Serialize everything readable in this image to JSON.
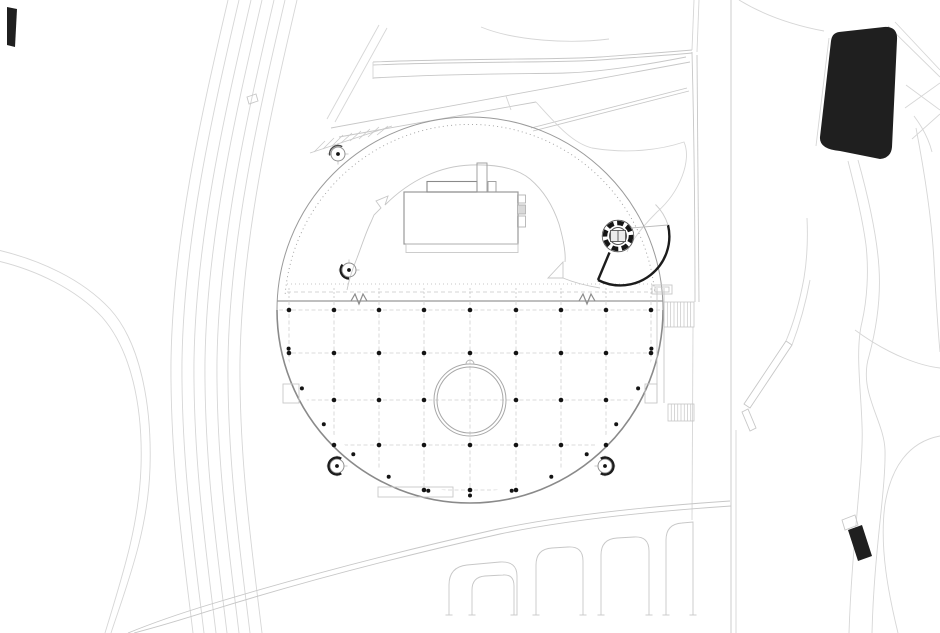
{
  "meta": {
    "type": "architectural-site-plan",
    "width": 940,
    "height": 633,
    "visible_text": "none"
  },
  "colors": {
    "paper": "#ffffff",
    "ink": "#1f1f1f",
    "line_dark": "#8c8c8c",
    "line_mid": "#a8a8a8",
    "line_light": "#c7c7c7",
    "line_faint": "#dedede",
    "dot": "#141414"
  },
  "plaza": {
    "cx": 470,
    "cy": 310,
    "r": 193,
    "chord_y": 301
  },
  "grid": {
    "columns_x": [
      289,
      334,
      379,
      424,
      470,
      516,
      561,
      606,
      651
    ],
    "rows_y": [
      310,
      353,
      400,
      445,
      490
    ],
    "grid_bottom_y": 504,
    "dot_radius": 2.3,
    "dot_rows": [
      {
        "y": 310,
        "x": [
          289,
          334,
          379,
          424,
          470,
          516,
          561,
          606,
          651
        ]
      },
      {
        "y": 353,
        "x": [
          289,
          334,
          379,
          424,
          470,
          516,
          561,
          606,
          651
        ]
      },
      {
        "y": 400,
        "x": [
          334,
          379,
          424,
          516,
          561,
          606
        ]
      },
      {
        "y": 445,
        "x": [
          334,
          379,
          424,
          470,
          516,
          561,
          606
        ]
      },
      {
        "y": 490,
        "x": [
          424,
          470,
          516
        ]
      }
    ],
    "perimeter": {
      "r": 185.5,
      "angles_deg": [
        12,
        25,
        38,
        51,
        64,
        77,
        90,
        103,
        116,
        129,
        142,
        155,
        168
      ]
    }
  },
  "central_opening": {
    "cx": 470,
    "cy": 400,
    "r_outer": 36,
    "r_inner": 33
  },
  "ramp": {
    "cx": 618,
    "cy": 236,
    "ring_r": 13,
    "ring_width": 4.5,
    "inner_r": 8.5,
    "fan_r": 49
  },
  "survey_markers": [
    {
      "x": 338,
      "y": 154,
      "ring_r": 7,
      "arc": {
        "r": 8.5,
        "from": 170,
        "to": 300,
        "width": 1.4,
        "color": "#4a4a4a"
      }
    },
    {
      "x": 349,
      "y": 270,
      "ring_r": 7,
      "arc": {
        "r": 8.5,
        "from": 90,
        "to": 220,
        "width": 2.2,
        "color": "#1c1c1c"
      }
    },
    {
      "x": 337,
      "y": 466,
      "ring_r": 7,
      "arc": {
        "r": 8.5,
        "from": 60,
        "to": 300,
        "width": 2.4,
        "color": "#1c1c1c"
      }
    },
    {
      "x": 605,
      "y": 466,
      "ring_r": 7,
      "arc": {
        "r": 8.5,
        "from": 240,
        "to": 480,
        "width": 2.4,
        "color": "#1c1c1c"
      }
    }
  ],
  "stairs": [
    {
      "x": 664,
      "y": 302,
      "w": 30,
      "h": 25,
      "treads": 9
    },
    {
      "x": 668,
      "y": 404,
      "w": 26,
      "h": 17,
      "treads": 8
    }
  ],
  "bay_serif_xs": [
    449,
    472,
    514,
    536,
    583,
    601,
    649,
    666,
    693
  ]
}
